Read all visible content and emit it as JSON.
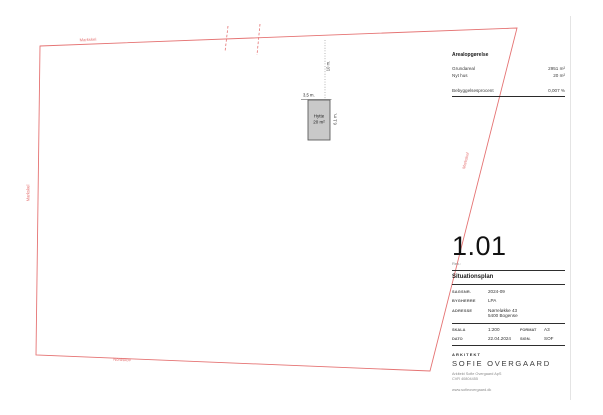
{
  "plan": {
    "boundary_labels": {
      "top": "Markskel",
      "left": "Markskel",
      "bottom": "Nordskov",
      "right": "Markskel"
    },
    "building": {
      "name": "Hytte",
      "area": "20 m²"
    },
    "dimensions": {
      "width": "3,5 m.",
      "depth": "6,1 m.",
      "setback": "10 m."
    }
  },
  "area_table": {
    "title": "Arealopgørelse",
    "rows": [
      {
        "label": "Grundareal",
        "value": "2951 m²"
      },
      {
        "label": "Nyt hus",
        "value": "20 m²"
      }
    ],
    "result": {
      "label": "Bebyggelsesprocent",
      "value": "0,007 %"
    }
  },
  "title_block": {
    "number": "1.01",
    "revision": "Rev.:",
    "title": "Situationsplan",
    "info": {
      "sagsnr_label": "SAGSNR.",
      "sagsnr": "2024-09",
      "bygherre_label": "BYGHERRE",
      "bygherre": "LPA",
      "adresse_label": "ADRESSE",
      "adresse_line1": "Nørreløkke 43",
      "adresse_line2": "5400 Bogense",
      "skala_label": "SKALA",
      "skala": "1:200",
      "format_label": "FORMAT",
      "format": "A3",
      "dato_label": "DATO",
      "dato": "22.04.2024",
      "sign_label": "SIGN.",
      "sign": "SOF"
    },
    "architect": {
      "role": "ARKITEKT",
      "name": "SOFIE OVERGAARD",
      "company": "Arkitekt Sofie Overgaard ApS",
      "cvr": "CVR 40804455",
      "website": "www.sofieovergaard.dk"
    }
  },
  "colors": {
    "boundary_red": "#e57373",
    "building_fill": "#c9c9c9",
    "building_stroke": "#5c5c5c",
    "ink": "#222222",
    "muted": "#8a8a8a"
  }
}
